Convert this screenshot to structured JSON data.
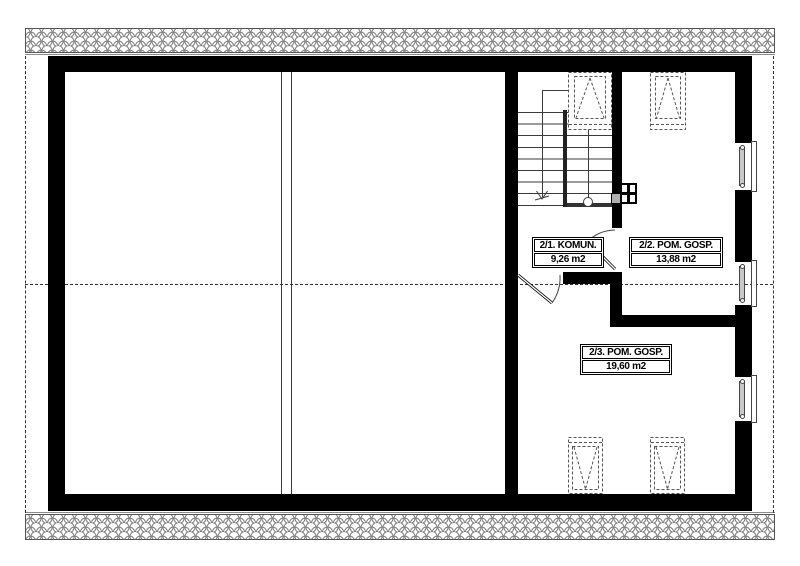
{
  "drawing": {
    "type": "attic floor plan",
    "rooms": [
      {
        "label": "2/1. KOMUN.",
        "area": "9,26 m2"
      },
      {
        "label": "2/2. POM. GOSP.",
        "area": "13,88 m2"
      },
      {
        "label": "2/3. POM. GOSP.",
        "area": "19,60 m2"
      }
    ],
    "colors": {
      "wall": "#000000",
      "detail_line": "#3c3c3c",
      "dashed_line": "#555555",
      "hatch_line": "#808080",
      "background": "#ffffff"
    }
  }
}
